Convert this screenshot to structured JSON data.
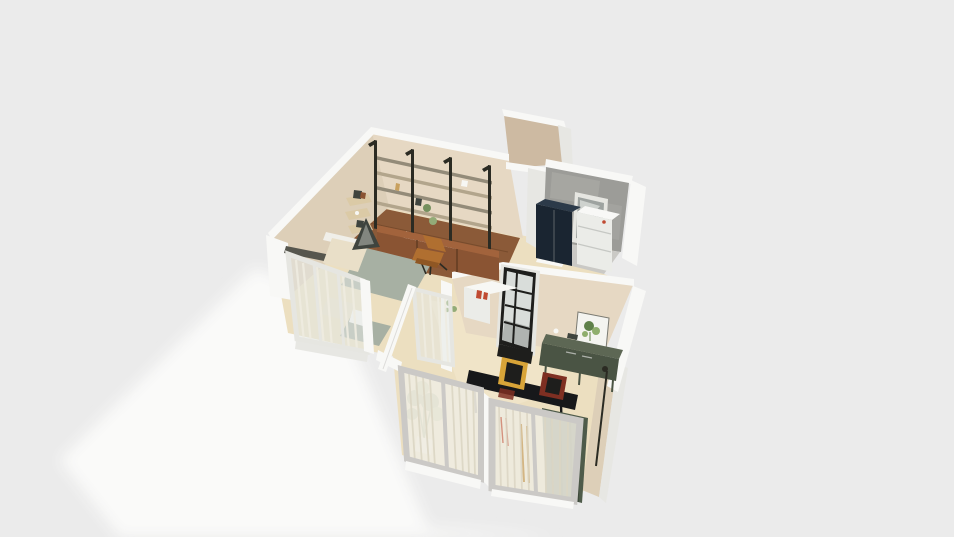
{
  "scene": {
    "description": "isometric 3D floor plan render of a small apartment, cutaway walls, no UI text",
    "background": "#ebebeb",
    "ground_shadow": "#fcfcfb"
  },
  "colors": {
    "white_wall": "#f8f8f6",
    "white_wall_shade": "#e7e7e3",
    "beige_wall": "#e6d8c3",
    "beige_wall_dark": "#ddcfb8",
    "tan_wall": "#cdbaa2",
    "cream_floor": "#ecdfc0",
    "cream_floor_light": "#f3e9d0",
    "wood_floor": "#8b5a38",
    "wood_floor_dark": "#6f4527",
    "shelf_metal": "#2b2b23",
    "shelf_wood": "#b2a58c",
    "shelf_wood_dark": "#938b79",
    "cabinet_front": "#8a5433",
    "cabinet_top": "#a2633c",
    "cabinet_seam": "#5f3a22",
    "corner_shelf": "#dbcaa6",
    "ledge_dark": "#56564e",
    "chair_leather": "#b06f30",
    "chair_leather_dark": "#8f5724",
    "bed_linen": "#e9dfc8",
    "bed_white": "#f0efe9",
    "duvet": "#a7b0a3",
    "teepee": "#3f443e",
    "teepee_light": "#b9bdb4",
    "glass": "#e3e8e4",
    "sheer": "#efece1",
    "sheer_stripe": "#dcd6c4",
    "frame_white": "#e6e6e1",
    "frame_gray": "#cbc9c6",
    "concrete": "#9c9c98",
    "concrete_light": "#aeaeaa",
    "navy": "#1a2531",
    "navy_top": "#2c3a49",
    "appliance": "#ebece8",
    "appliance_line": "#c6c8c4",
    "window_black": "#1e1e1c",
    "pane": "#d9ddda",
    "pane_dark": "#9ea3a0",
    "console_front": "#4a5444",
    "console_top": "#5d6754",
    "poster_bg": "#f4f4f0",
    "poster_green": "#5f8049",
    "poster_green_light": "#8fae6d",
    "curtain_green": "#4e5b4a",
    "curtain_green_dark": "#3c4739",
    "table_black": "#17181a",
    "frame_yellow": "#d8a438",
    "frame_maroon": "#7e2f22",
    "plant_green": "#75905e",
    "plant_green_light": "#93ab77",
    "plant_stem": "#5d7a4b",
    "pot_white": "#f7f7f4",
    "red_item": "#c04a32",
    "tan_item": "#c8a05e",
    "bath_floor": "#cac9c5"
  },
  "objects": [
    "wall-shelving-unit",
    "base-cabinets",
    "corner-wall-shelves",
    "lounge-chair",
    "double-bed",
    "teepee-decor",
    "bedside-table",
    "bedroom-glass-partition",
    "open-glass-door",
    "sheer-curtains",
    "utility-room",
    "fridge-cabinet",
    "washer-cabinet",
    "utility-window",
    "tall-wall-column",
    "steel-frame-window",
    "kitchen-counter",
    "botanical-poster",
    "green-sideboard",
    "floor-lamp",
    "dining-table",
    "leaning-frame-yellow",
    "leaning-frame-maroon",
    "potted-tree",
    "hanging-plant",
    "green-curtain",
    "sliding-window-wall"
  ]
}
